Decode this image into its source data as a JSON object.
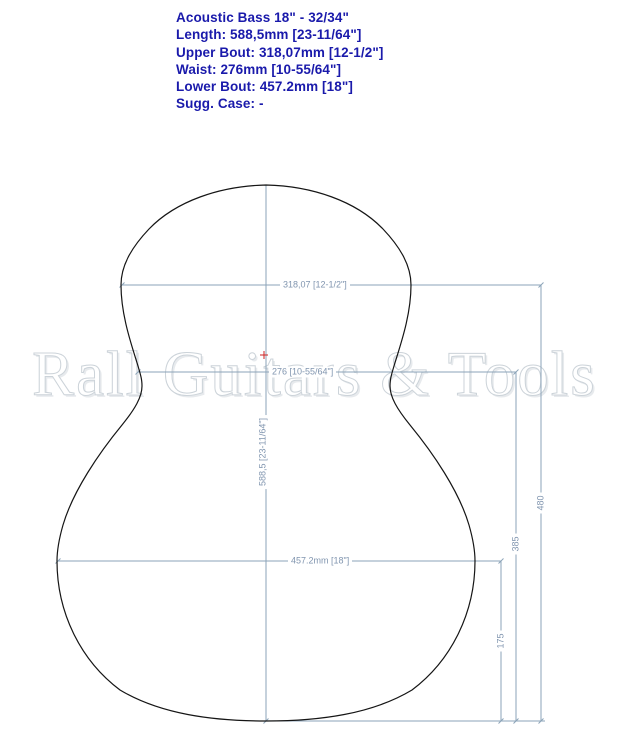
{
  "header": {
    "lines": [
      "Acoustic Bass 18\" - 32/34\"",
      "Length: 588,5mm [23-11/64\"]",
      "Upper Bout: 318,07mm [12-1/2\"]",
      "Waist: 276mm [10-55/64\"]",
      "Lower Bout: 457.2mm [18\"]",
      "Sugg. Case: -"
    ]
  },
  "watermark": {
    "text": "Rall Guitars & Tools"
  },
  "diagram": {
    "dimensions": {
      "upper_bout": "318,07 [12-1/2\"]",
      "waist": "276 [10-55/64\"]",
      "lower_bout": "457.2mm [18\"]",
      "length": "588,5 [23-11/64\"]",
      "upper_bout_to_bottom": "480",
      "waist_to_bottom": "385",
      "lower_bout_to_bottom": "175"
    }
  },
  "colors": {
    "heading_text": "#1a1aab",
    "dimension_line": "#8ba3b8",
    "dimension_text": "#8095af",
    "body_outline": "#151515",
    "watermark_outline": "#ccd3d9",
    "center_marker": "#cc2222",
    "background": "#ffffff"
  }
}
